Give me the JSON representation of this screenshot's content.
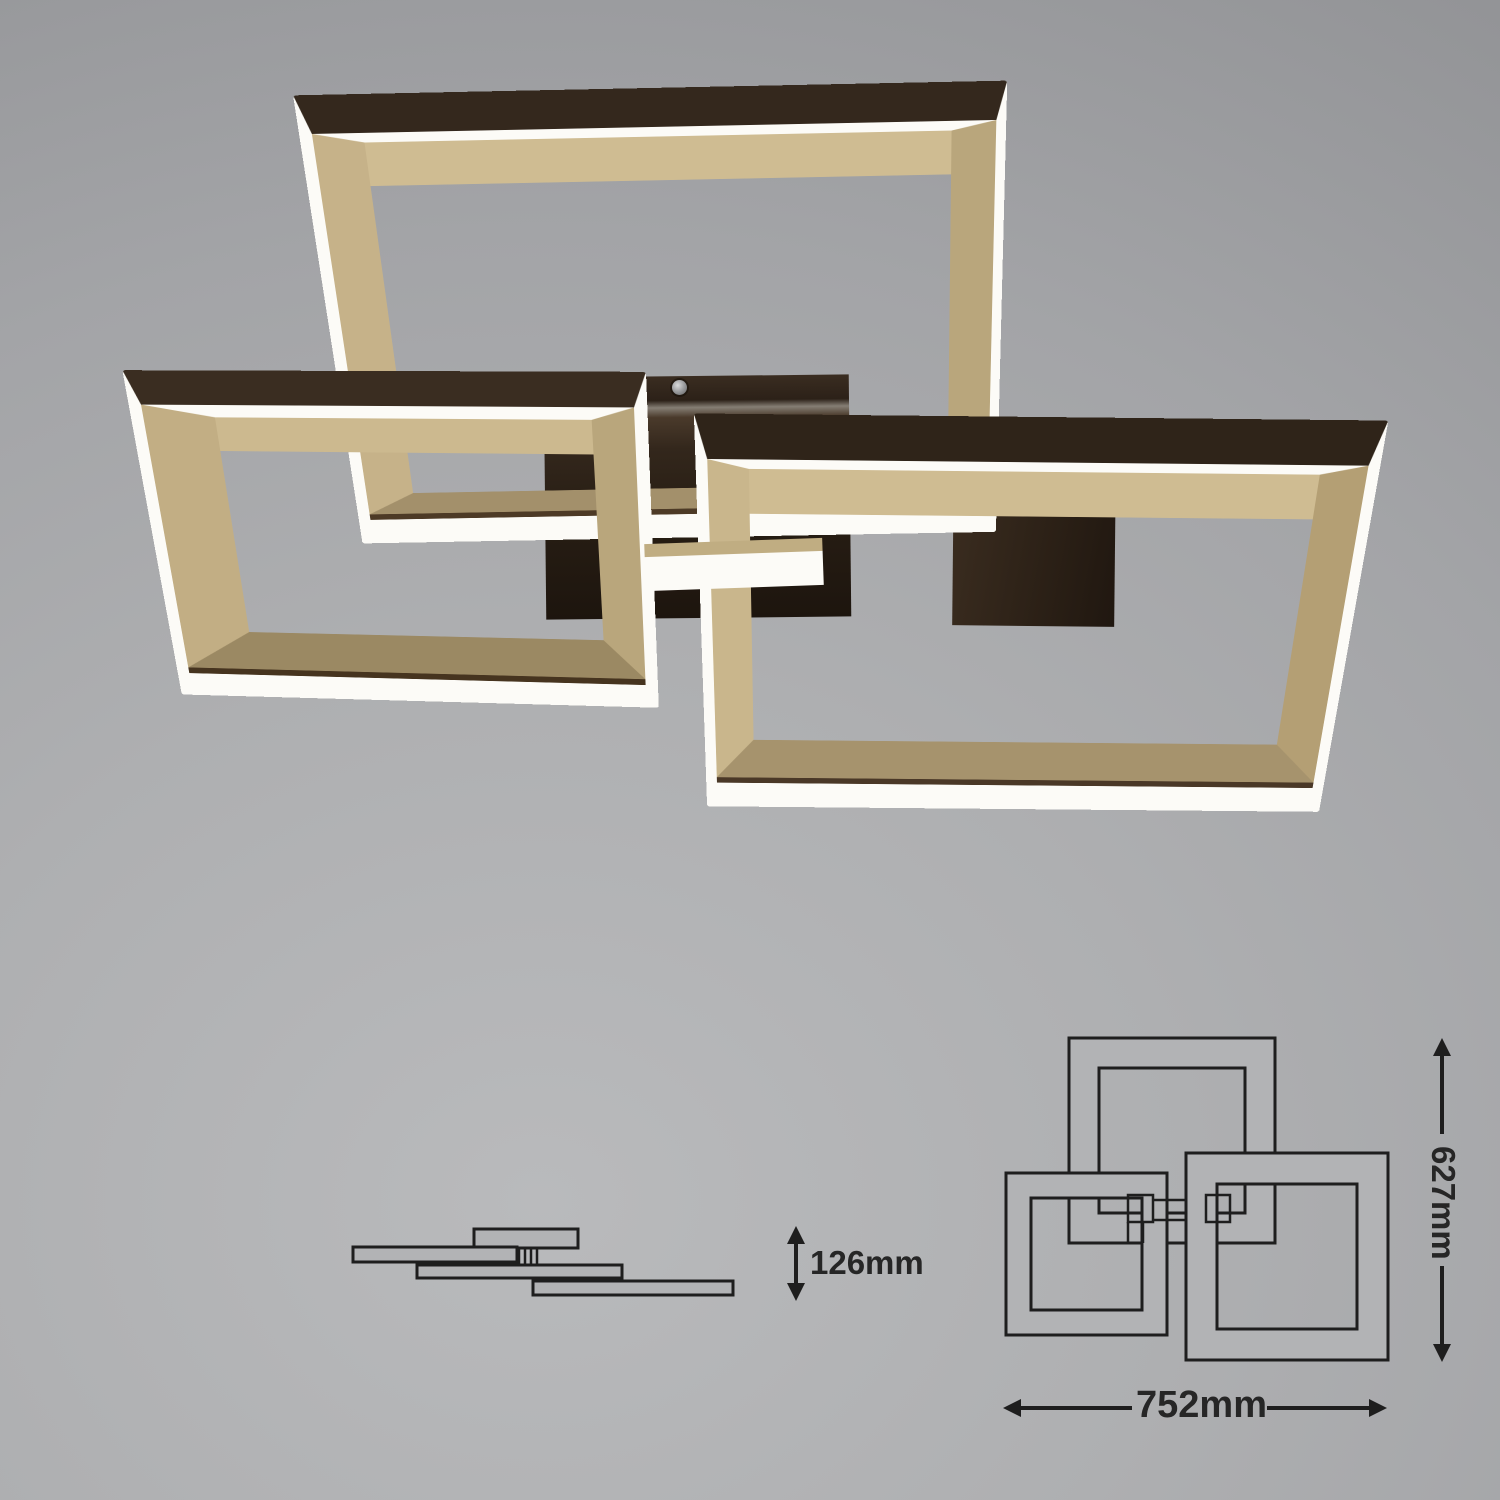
{
  "scene": {
    "background_color": "#aaabad",
    "product": {
      "frame_top_face_color": "#34281d",
      "frame_inner_gold_color": "#c6b289",
      "led_edge_color": "#fcfbf7"
    }
  },
  "dimensions": {
    "height_label": "126mm",
    "width_label": "752mm",
    "depth_label": "627mm"
  },
  "diagram": {
    "line_color": "#1e1e1e"
  }
}
